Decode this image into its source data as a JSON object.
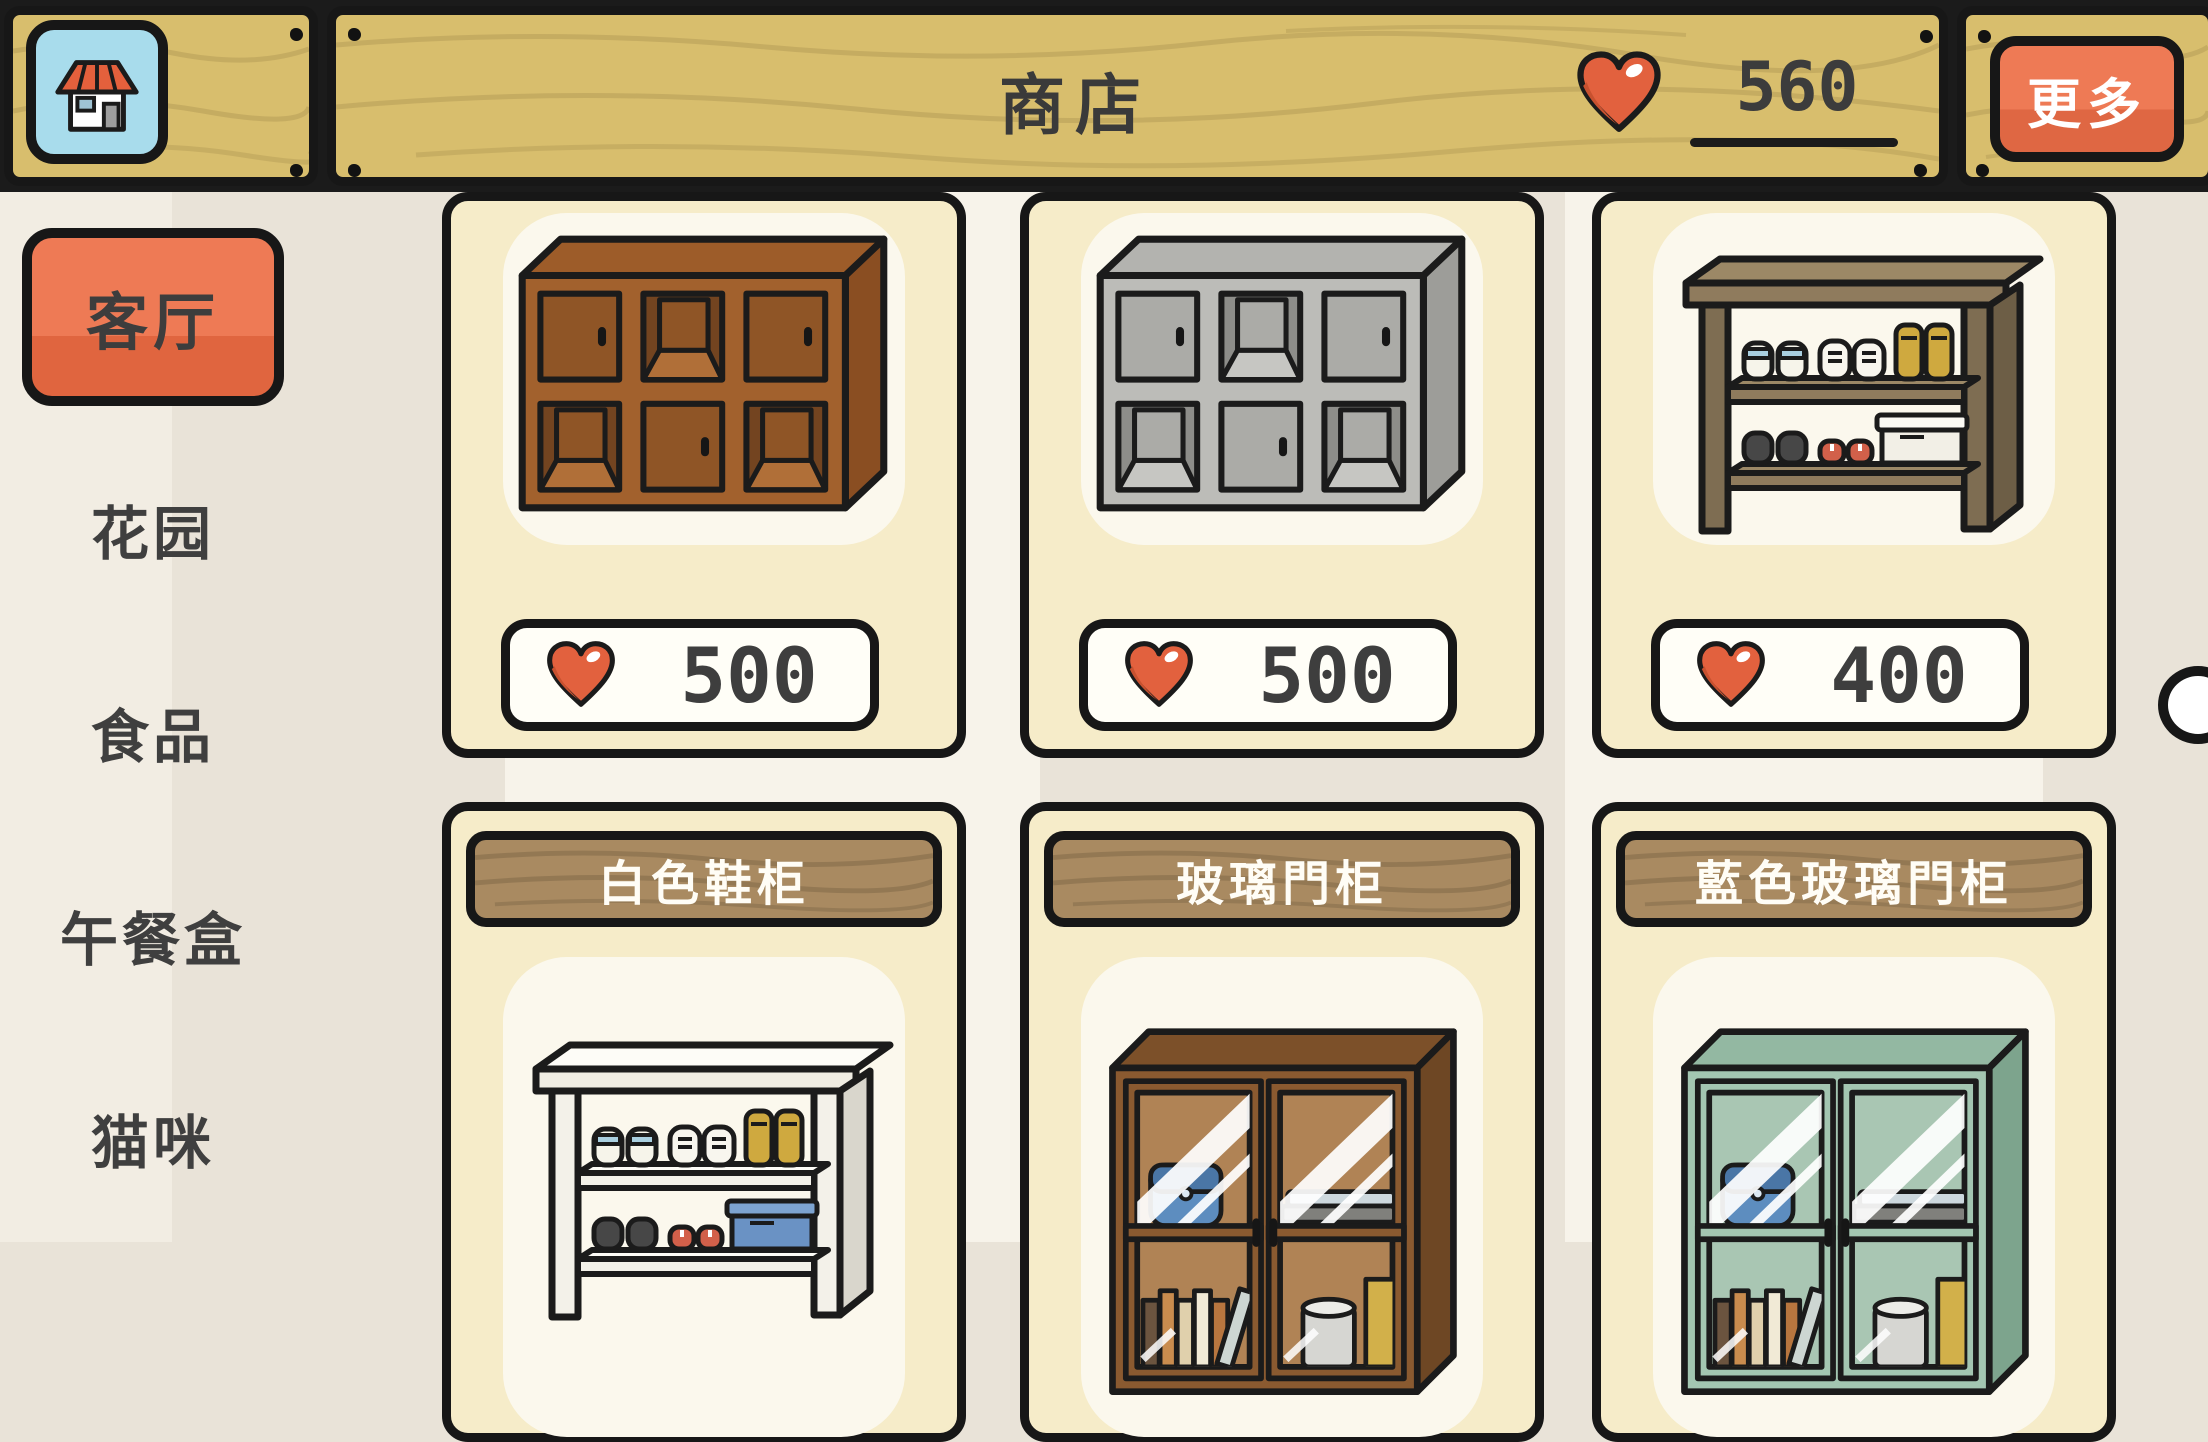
{
  "header": {
    "title": "商店",
    "home_button": {
      "icon": "shop-house-icon"
    },
    "currency": {
      "icon": "heart-icon",
      "amount": "560"
    },
    "more_button": {
      "label": "更多"
    }
  },
  "sidebar": {
    "items": [
      {
        "label": "客厅",
        "selected": true
      },
      {
        "label": "花园",
        "selected": false
      },
      {
        "label": "食品",
        "selected": false
      },
      {
        "label": "午餐盒",
        "selected": false
      },
      {
        "label": "猫咪",
        "selected": false
      }
    ]
  },
  "shop": {
    "rows": [
      {
        "items": [
          {
            "price": "500",
            "art": "cube-cabinet",
            "variant": "cube_brown"
          },
          {
            "price": "500",
            "art": "cube-cabinet",
            "variant": "cube_gray"
          },
          {
            "price": "400",
            "art": "shoe-rack",
            "variant": "rack_wood"
          }
        ]
      },
      {
        "items": [
          {
            "name": "白色鞋柜",
            "art": "shoe-rack",
            "variant": "rack_white"
          },
          {
            "name": "玻璃門柜",
            "art": "glass-cabinet",
            "variant": "glass_brown"
          },
          {
            "name": "藍色玻璃門柜",
            "art": "glass-cabinet",
            "variant": "glass_teal"
          }
        ]
      }
    ]
  },
  "palettes": {
    "cube_brown": {
      "top": "#9d5c29",
      "side": "#8a4e22",
      "face": "#a2612d",
      "door": "#8f5526",
      "open": "#734420",
      "floor": "#b06f38"
    },
    "cube_gray": {
      "top": "#b3b3af",
      "side": "#9d9d99",
      "face": "#bcbcb8",
      "door": "#ababa7",
      "open": "#8d8d89",
      "floor": "#c6c6c2"
    },
    "rack_wood": {
      "topTop": "#9c8866",
      "top": "#8f7b5d",
      "front": "#6d5e46",
      "leg": "#7e6d52",
      "shelf": "#8f7b5d",
      "box": "#f2efe6",
      "boxLid": "#fbfaf4"
    },
    "rack_white": {
      "topTop": "#fdfcf7",
      "top": "#efece2",
      "front": "#d9d6cc",
      "leg": "#f3f1e9",
      "shelf": "#f3f1e9",
      "box": "#6a92c4",
      "boxLid": "#7da3d0"
    },
    "glass_brown": {
      "top": "#7c5029",
      "side": "#6e4724",
      "frame": "#8a5a30",
      "pane": "#b08355"
    },
    "glass_teal": {
      "top": "#93b8a2",
      "side": "#7da48d",
      "frame": "#a3c6b1",
      "pane": "#a9c6b3"
    }
  },
  "colors": {
    "accent_orange": "#ee7a55",
    "wood_tan": "#d8be6d",
    "card_bg": "#f6ecc9",
    "heart_red": "#e2613e",
    "outline": "#171717",
    "page_bg": "#e9e3d8"
  }
}
